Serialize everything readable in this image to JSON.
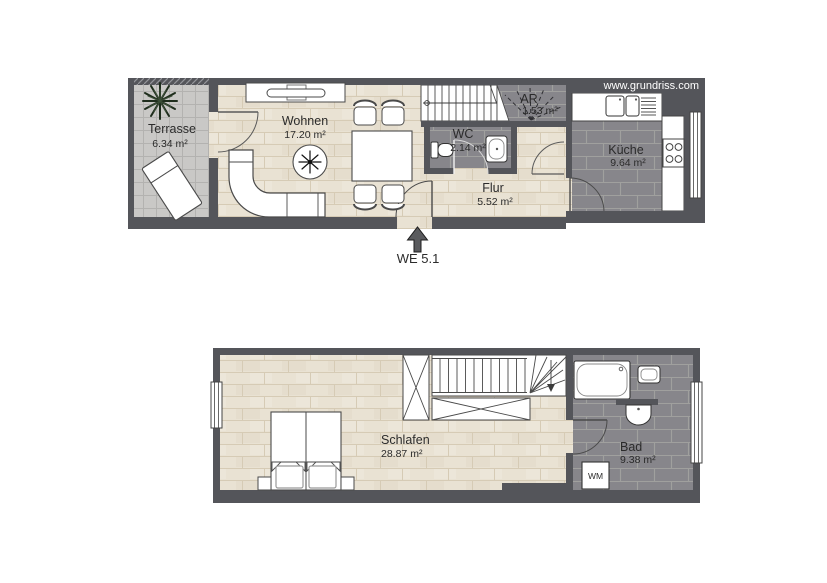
{
  "watermark": "www.grundriss.com",
  "floors": {
    "upper": {
      "entrance_label": "WE 5.1",
      "rooms": [
        {
          "name": "Terrasse",
          "area": "6.34 m²"
        },
        {
          "name": "Wohnen",
          "area": "17.20 m²"
        },
        {
          "name": "AR",
          "area": "1.53 m²"
        },
        {
          "name": "WC",
          "area": "2.14 m²"
        },
        {
          "name": "Flur",
          "area": "5.52 m²"
        },
        {
          "name": "Küche",
          "area": "9.64 m²"
        }
      ]
    },
    "lower": {
      "rooms": [
        {
          "name": "Schlafen",
          "area": "28.87 m²"
        },
        {
          "name": "Bad",
          "area": "9.38 m²"
        }
      ],
      "washing_machine_label": "WM"
    }
  },
  "colors": {
    "wall": "#54555a",
    "wood_floor": "#e9e2d3",
    "dark_tile": "#87868b",
    "terrace_tile": "#c9c8c6"
  }
}
